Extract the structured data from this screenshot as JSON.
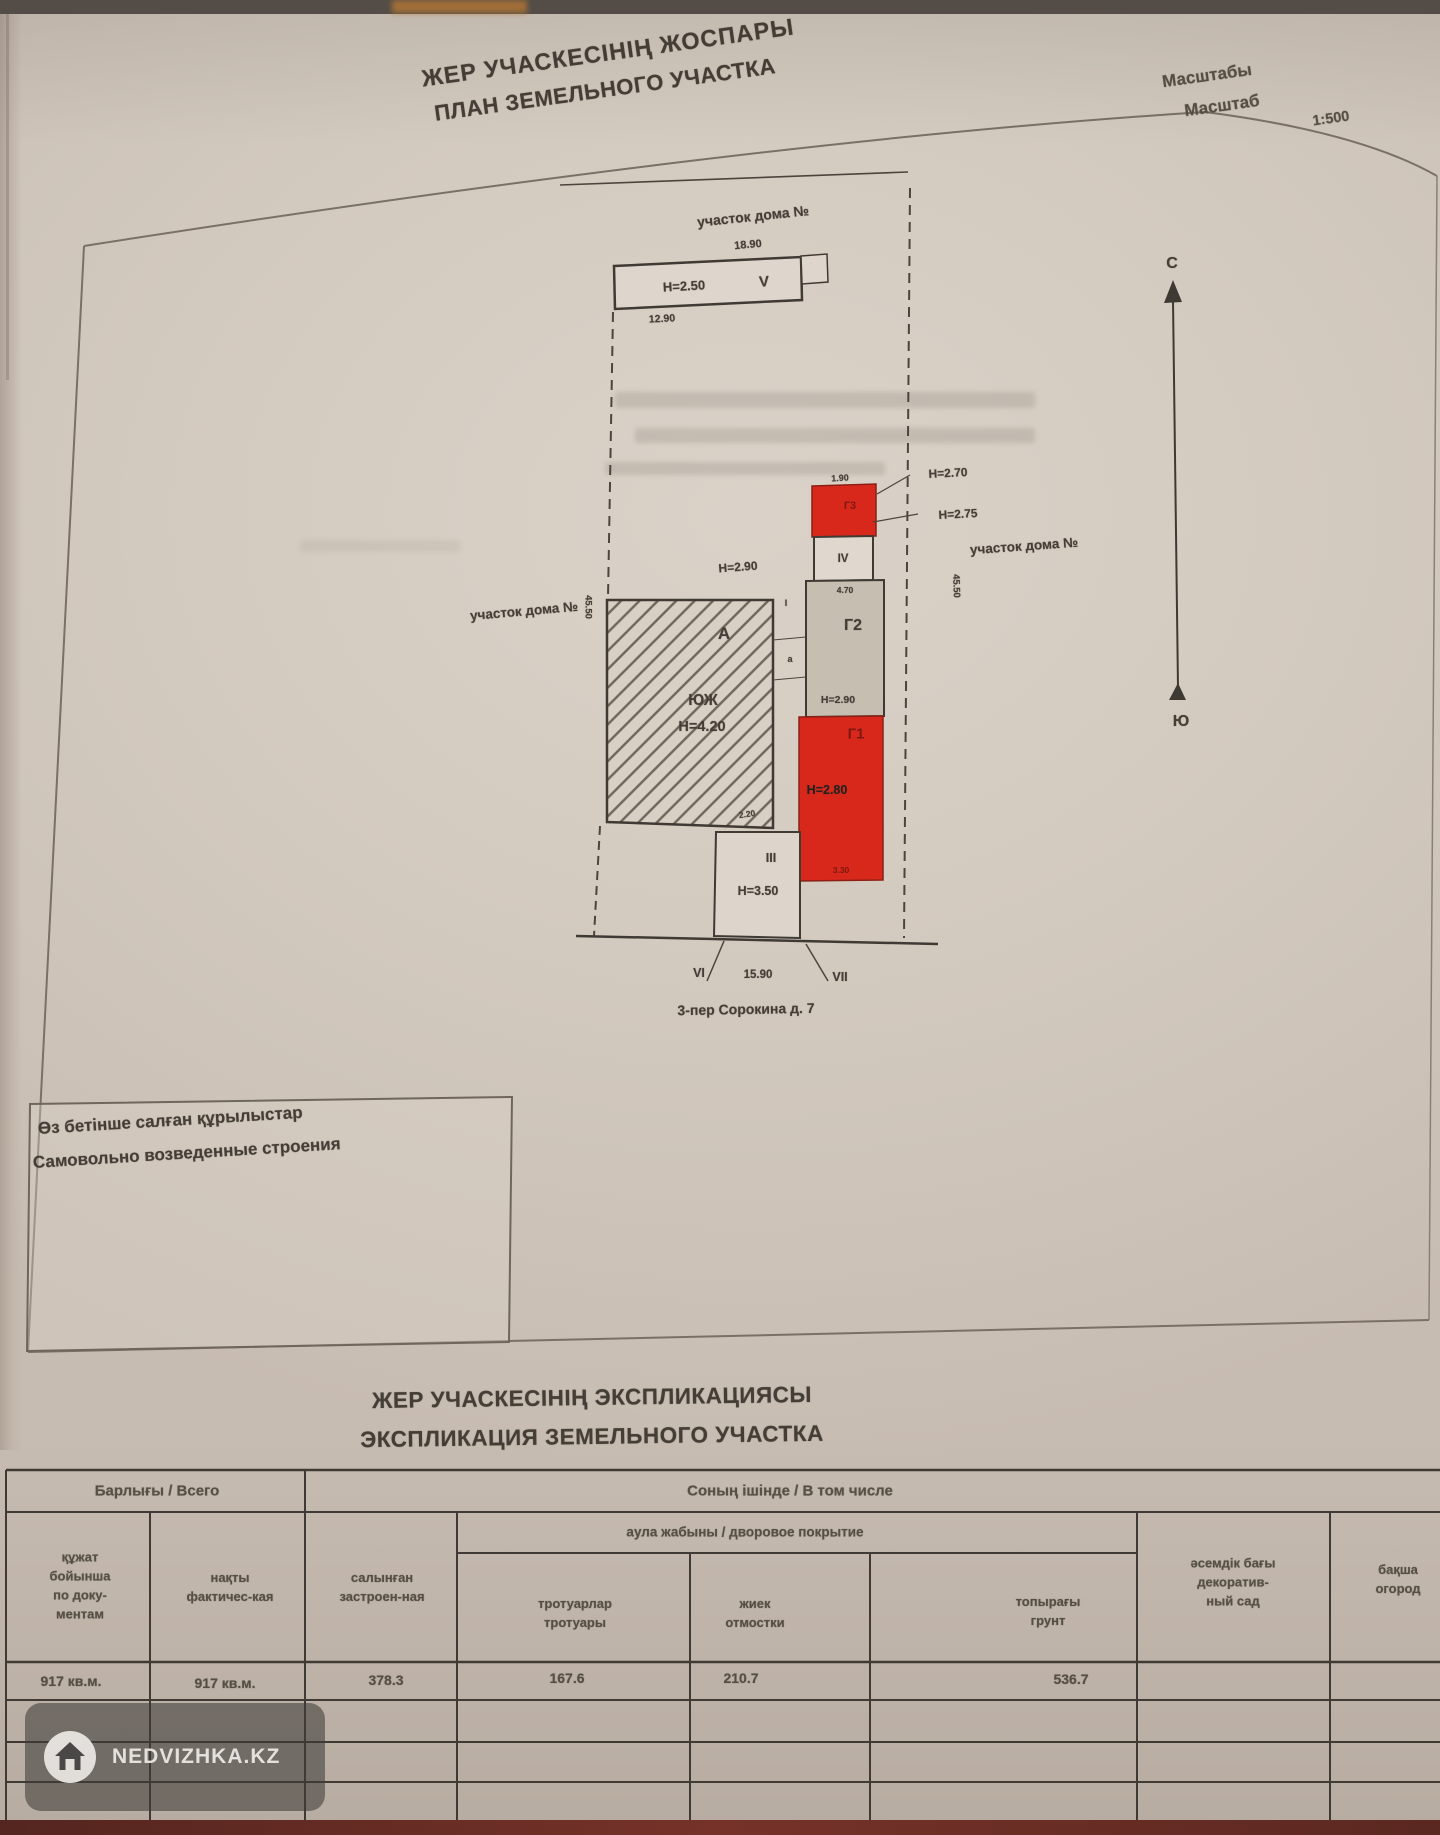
{
  "header": {
    "title_kk": "ЖЕР УЧАСКЕСІНІҢ ЖОСПАРЫ",
    "title_ru": "ПЛАН ЗЕМЕЛЬНОГО УЧАСТКА",
    "scale_kk": "Масштабы",
    "scale_ru": "Масштаб",
    "scale_value": "1:500"
  },
  "plan": {
    "neighbor_top": "участок дома №",
    "neighbor_left": "участок дома №",
    "neighbor_right": "участок дома №",
    "dim_top": "18.90",
    "dim_v": "12.90",
    "dim_left": "45.50",
    "dim_right": "45.50",
    "dim_bottom": "15.90",
    "dim_g3": "1.90",
    "dim_g2": "4.70",
    "dim_a": "2.20",
    "dim_g1": "3.30",
    "v_height": "Н=2.50",
    "v_label": "V",
    "h270": "Н=2.70",
    "h275": "Н=2.75",
    "h290_top": "Н=2.90",
    "h290_g2": "Н=2.90",
    "g3_label": "Г3",
    "iv_label": "IV",
    "g2_label": "Г2",
    "g1_label": "Г1",
    "g1_height": "Н=2.80",
    "a_label": "А",
    "a_material": "ЮЖ",
    "a_height": "Н=4.20",
    "iii_label": "III",
    "iii_height": "Н=3.50",
    "strip_i": "I",
    "strip_a": "а",
    "vi_label": "VI",
    "vii_label": "VII",
    "north": "С",
    "south": "Ю",
    "address": "3-пер Сорокина д. 7"
  },
  "selfbuild": {
    "kk": "Өз бетінше салған құрылыстар",
    "ru": "Самовольно возведенные строения"
  },
  "explication": {
    "title_kk": "ЖЕР УЧАСКЕСІНІҢ ЭКСПЛИКАЦИЯСЫ",
    "title_ru": "ЭКСПЛИКАЦИЯ ЗЕМЕЛЬНОГО УЧАСТКА",
    "group_total": "Барлығы / Всего",
    "group_including": "Соның ішінде / В том числе",
    "group_yard": "аула жабыны / дворовое покрытие",
    "col_docs": "құжат\nбойынша\nпо доку-\nментам",
    "col_fact": "нақты\nфактичес-кая",
    "col_built": "салынған\nзастроен-ная",
    "col_side": "тротуарлар\nтротуары",
    "col_blind": "жиек\nотмостки",
    "col_soil": "топырағы\nгрунт",
    "col_garden": "әсемдік бағы\nдекоратив-\nный сад",
    "col_kitchen": "бақша\nогород",
    "val_docs": "917 кв.м.",
    "val_fact": "917 кв.м.",
    "val_built": "378.3",
    "val_side": "167.6",
    "val_blind": "210.7",
    "val_soil": "536.7"
  },
  "watermark": {
    "text": "NEDVIZHKA.KZ",
    "icon": "home-icon"
  }
}
